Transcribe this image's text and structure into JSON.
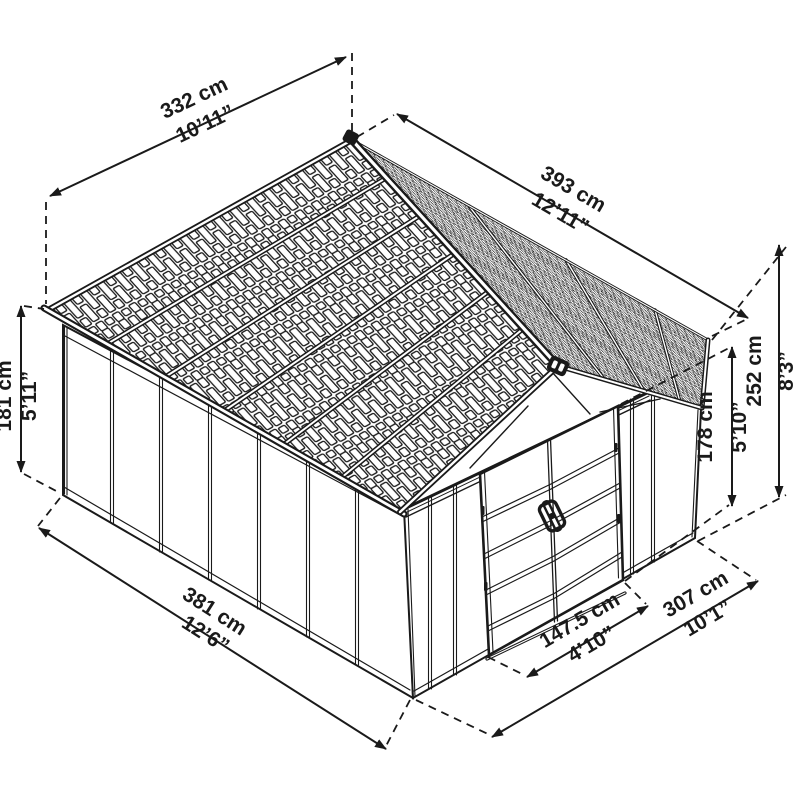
{
  "diagram": {
    "type": "shed-dimension-drawing",
    "background": "#ffffff",
    "line_color": "#1a1a1a",
    "dimensions": {
      "roof_width": {
        "metric": "332 cm",
        "imperial": "10’11”"
      },
      "roof_length": {
        "metric": "393 cm",
        "imperial": "12’11”"
      },
      "wall_height": {
        "metric": "181 cm",
        "imperial": "5’11”"
      },
      "total_height": {
        "metric": "252 cm",
        "imperial": "8’3”"
      },
      "door_height": {
        "metric": "178 cm",
        "imperial": "5’10”"
      },
      "base_length": {
        "metric": "381 cm",
        "imperial": "12’6”"
      },
      "door_width": {
        "metric": "147.5 cm",
        "imperial": "4’10”"
      },
      "base_width": {
        "metric": "307 cm",
        "imperial": "10’1”"
      }
    }
  }
}
